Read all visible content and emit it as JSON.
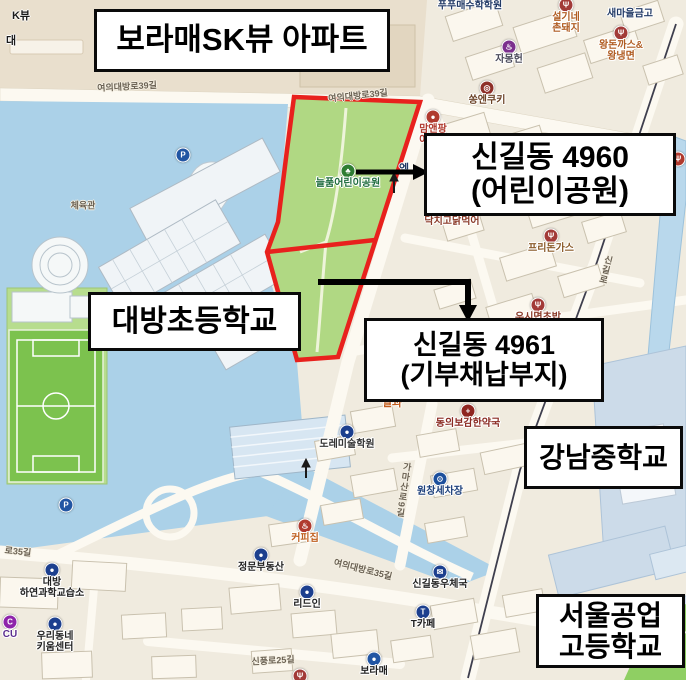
{
  "callouts": {
    "apartment": "보라매SK뷰 아파트",
    "park4960": {
      "line1": "신길동 4960",
      "line2": "(어린이공원)"
    },
    "site4961": {
      "line1": "신길동 4961",
      "line2": "(기부채납부지)"
    },
    "elementary": "대방초등학교",
    "middle_school": "강남중학교",
    "high_school": {
      "line1": "서울공업",
      "line2": "고등학교"
    }
  },
  "map": {
    "streets": [
      {
        "text": "여의대방로39길",
        "x": 127,
        "y": 86,
        "rot": -3
      },
      {
        "text": "여의대방로39길",
        "x": 358,
        "y": 95,
        "rot": -6
      },
      {
        "text": "여의대방로35길",
        "x": 363,
        "y": 569,
        "rot": 14
      },
      {
        "text": "로35길",
        "x": 18,
        "y": 551,
        "rot": 6
      },
      {
        "text": "신풍로25길",
        "x": 273,
        "y": 660,
        "rot": -3
      },
      {
        "text": "가마산로9길",
        "x": 404,
        "y": 490,
        "rot": 8,
        "vertical": true
      },
      {
        "text": "신길로",
        "x": 606,
        "y": 270,
        "rot": 14,
        "vertical": true
      },
      {
        "text": "체육관",
        "x": 83,
        "y": 205,
        "rot": 0
      },
      {
        "text": "204",
        "x": 373,
        "y": 41,
        "rot": 0,
        "small": true
      }
    ],
    "pois": [
      {
        "x": 470,
        "y": 6,
        "label": "푸푸매수학학원",
        "label_color": "#223a66",
        "type": "academy"
      },
      {
        "x": 630,
        "y": 14,
        "label": "새마을금고",
        "label_color": "#223a66",
        "type": "bank"
      },
      {
        "x": 566,
        "y": 5,
        "icon_color": "#a23a38",
        "glyph": "Ψ",
        "label": "설기네\n촌돼지",
        "label_color": "#b05c22",
        "type": "restaurant"
      },
      {
        "x": 621,
        "y": 33,
        "icon_color": "#a23a38",
        "glyph": "Ψ",
        "label": "왕돈까스&\n왕냉면",
        "label_color": "#b05c22",
        "type": "restaurant"
      },
      {
        "x": 509,
        "y": 47,
        "icon_color": "#7b2f8e",
        "glyph": "♨",
        "label": "자몽헌",
        "label_color": "#4a4a5a",
        "type": "cafe"
      },
      {
        "x": 487,
        "y": 88,
        "icon_color": "#8e2f28",
        "glyph": "◎",
        "label": "쏭엔쿠키",
        "label_color": "#6b4226",
        "type": "bakery"
      },
      {
        "x": 433,
        "y": 117,
        "icon_color": "#b03a2e",
        "glyph": "●",
        "label": "맘앤팡\n아이스",
        "label_color": "#b03a2e",
        "type": "shop"
      },
      {
        "x": 348,
        "y": 171,
        "icon_color": "#2e7d32",
        "glyph": "♣",
        "label": "늘품어린이공원",
        "label_color": "#1d6b3c",
        "type": "park"
      },
      {
        "x": 452,
        "y": 209,
        "icon_color": "#a23a38",
        "glyph": "Ψ",
        "label": "닥치고닭먹어",
        "label_color": "#8a3a28",
        "type": "restaurant"
      },
      {
        "x": 551,
        "y": 236,
        "icon_color": "#a23a38",
        "glyph": "Ψ",
        "label": "프리돈가스",
        "label_color": "#8a5a28",
        "type": "restaurant"
      },
      {
        "x": 678,
        "y": 159,
        "icon_color": "#b03a2e",
        "glyph": "Ψ",
        "label": "피자",
        "label_color": "#b03a2e",
        "label_x": 669,
        "type": "restaurant"
      },
      {
        "x": 538,
        "y": 305,
        "icon_color": "#a23a38",
        "glyph": "Ψ",
        "label": "우시면초밥",
        "label_color": "#8a3a28",
        "type": "restaurant"
      },
      {
        "x": 468,
        "y": 411,
        "icon_color": "#8e2520",
        "glyph": "+",
        "label": "동의보감한약국",
        "label_color": "#8a2a22",
        "type": "pharmacy"
      },
      {
        "x": 440,
        "y": 479,
        "icon_color": "#1c4f9c",
        "glyph": "⊙",
        "label": "원창세차장",
        "label_color": "#1c3f7a",
        "type": "carwash"
      },
      {
        "x": 347,
        "y": 432,
        "icon_color": "#1c3f8e",
        "glyph": "●",
        "label": "도레미술학원",
        "label_color": "#333333",
        "type": "academy"
      },
      {
        "x": 305,
        "y": 526,
        "icon_color": "#b03a2e",
        "glyph": "♨",
        "label": "커피집",
        "label_color": "#c06020",
        "type": "cafe"
      },
      {
        "x": 261,
        "y": 555,
        "icon_color": "#1c3f8e",
        "glyph": "●",
        "label": "정문부동산",
        "label_color": "#222222",
        "type": "realty"
      },
      {
        "x": 307,
        "y": 592,
        "icon_color": "#1c3f8e",
        "glyph": "●",
        "label": "리드인",
        "label_color": "#222222",
        "type": "shop"
      },
      {
        "x": 440,
        "y": 572,
        "icon_color": "#1c3f8e",
        "glyph": "✉",
        "label": "신길동우체국",
        "label_color": "#222222",
        "type": "post-office"
      },
      {
        "x": 423,
        "y": 612,
        "icon_color": "#1c3f8e",
        "glyph": "T",
        "label": "T카페",
        "label_color": "#222222",
        "type": "cafe"
      },
      {
        "x": 374,
        "y": 659,
        "icon_color": "#2155a3",
        "glyph": "●",
        "label": "보라매",
        "label_color": "#222222",
        "type": "shop"
      },
      {
        "x": 10,
        "y": 622,
        "icon_color": "#8e24aa",
        "glyph": "C",
        "label": "CU",
        "label_color": "#5b2d8e",
        "type": "convenience"
      },
      {
        "x": 52,
        "y": 570,
        "icon_color": "#1c3f8e",
        "glyph": "●",
        "label": "대방\n하연과학교습소",
        "label_color": "#222222",
        "type": "academy"
      },
      {
        "x": 55,
        "y": 624,
        "icon_color": "#1c3f8e",
        "glyph": "●",
        "label": "우리동네\n키움센터",
        "label_color": "#222222",
        "type": "center"
      },
      {
        "x": 300,
        "y": 676,
        "icon_color": "#a23a38",
        "glyph": "Ψ",
        "label": "",
        "type": "restaurant"
      },
      {
        "x": 183,
        "y": 155,
        "icon_color": "#2155a3",
        "glyph": "P",
        "label": "",
        "type": "parking"
      },
      {
        "x": 66,
        "y": 505,
        "icon_color": "#2155a3",
        "glyph": "P",
        "label": "",
        "type": "parking"
      }
    ],
    "texts": [
      {
        "text": "K뷰",
        "x": 21,
        "y": 15,
        "color": "#1a1a1a"
      },
      {
        "text": "대",
        "x": 11,
        "y": 40,
        "color": "#1a1a1a"
      },
      {
        "text": "엠",
        "x": 404,
        "y": 168,
        "color": "#223a66"
      },
      {
        "text": "열과",
        "x": 392,
        "y": 402,
        "color": "#c05a1a"
      }
    ],
    "colors": {
      "water": "#abd1e8",
      "park_green": "#b0d883",
      "field_green": "#7cc24e",
      "highlight_red": "#e8211d",
      "road": "#fcf9f1",
      "campus_blue": "#ccdbe9",
      "top_beige": "#e9dfcd"
    }
  }
}
